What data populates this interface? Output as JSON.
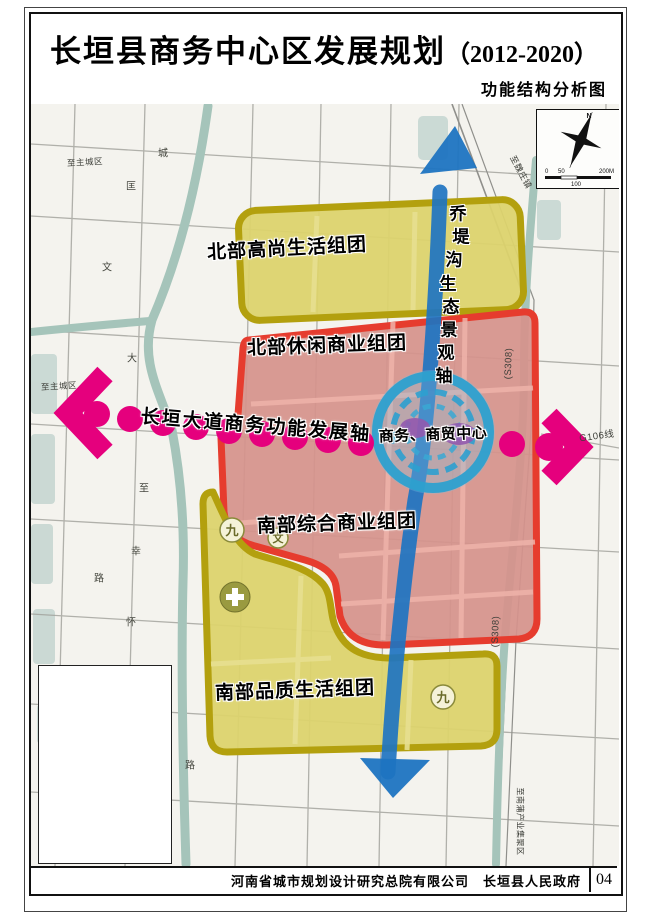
{
  "header": {
    "title": "长垣县商务中心区发展规划",
    "years": "（2012-2020）",
    "subtitle": "功能结构分析图"
  },
  "map": {
    "zones": [
      {
        "id": "north-living",
        "label": "北部高尚生活组团",
        "fill": "#dcd36d",
        "border": "#b3a00e"
      },
      {
        "id": "north-commercial",
        "label": "北部休闲商业组团",
        "fill": "#d5928c",
        "border": "#e63c2e"
      },
      {
        "id": "south-commercial",
        "label": "南部综合商业组团",
        "fill": "#d5928c",
        "border": "#e63c2e"
      },
      {
        "id": "south-living",
        "label": "南部品质生活组团",
        "fill": "#dcd36d",
        "border": "#b3a00e"
      },
      {
        "id": "business-center",
        "label": "商务、商贸中心",
        "ring_color": "#2da0cf"
      }
    ],
    "axes": {
      "eco": {
        "label": "乔堤沟生态景观轴",
        "chars": [
          "乔",
          "堤",
          "沟",
          "生",
          "态",
          "景",
          "观",
          "轴"
        ],
        "color": "#1e74c1"
      },
      "business": {
        "label": "长垣大道商务功能发展轴",
        "color": "#e5007d"
      }
    },
    "road_labels": [
      {
        "text": "至主城区"
      },
      {
        "text": "至主城区"
      },
      {
        "text": "至魏庄镇"
      },
      {
        "text": "G106线"
      },
      {
        "text": "(S308)"
      },
      {
        "text": "(S308)"
      },
      {
        "text": "至南蒲产业集聚区"
      }
    ],
    "road_chars": [
      "城",
      "匡",
      "文",
      "大",
      "至",
      "幸",
      "路",
      "怀",
      "路"
    ],
    "symbols": [
      {
        "glyph": "九",
        "meaning": "school-symbol"
      },
      {
        "glyph": "文",
        "meaning": "culture-symbol"
      },
      {
        "glyph": "九",
        "meaning": "school-symbol"
      }
    ],
    "compass": {
      "north_label": "N",
      "scale_ticks": [
        "0",
        "50",
        "100",
        "200M"
      ]
    }
  },
  "footer": {
    "company": "河南省城市规划设计研究总院有限公司",
    "government": "长垣县人民政府",
    "page_number": "04"
  },
  "colors": {
    "magenta_axis": "#e5007d",
    "eco_axis_blue": "#1e74c1",
    "center_ring_blue": "#2da0cf",
    "zone_red_fill": "#d5928c",
    "zone_red_border": "#e63c2e",
    "zone_yellow_fill": "#dcd36d",
    "zone_yellow_border": "#b3a00e",
    "river_teal": "#a5c4ba",
    "map_background": "#f4f3ee"
  }
}
